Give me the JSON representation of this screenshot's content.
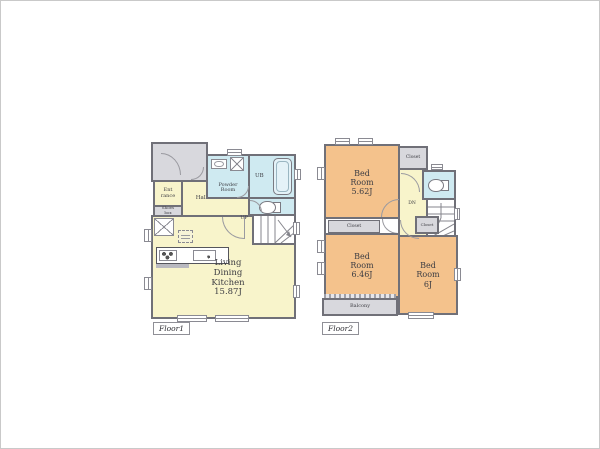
{
  "colors": {
    "wall": "#707078",
    "room_yellow": "#f8f4cb",
    "room_orange": "#f4c28c",
    "room_blue": "#cfeaf1",
    "area_gray": "#d8d8dd"
  },
  "floor1": {
    "label": "Floor1",
    "stairs_label": "UP",
    "rooms": {
      "entrance": "Ent rance",
      "shoes_box": "Shoes box",
      "hall": "Hall",
      "powder_room": "Powder Room",
      "bath": "UB",
      "ldk": {
        "name": "Living Dining Kitchen",
        "area": "15.87J"
      }
    }
  },
  "floor2": {
    "label": "Floor2",
    "stairs_label": "DN",
    "rooms": {
      "bedroom_top": {
        "name": "Bed Room",
        "area": "5.62J"
      },
      "bedroom_left": {
        "name": "Bed Room",
        "area": "6.46J"
      },
      "bedroom_right": {
        "name": "Bed Room",
        "area": "6J"
      },
      "closet_top": "Closet",
      "closet_mid": "Closet",
      "closet_inner": "Closet",
      "balcony": "Balcony"
    }
  }
}
